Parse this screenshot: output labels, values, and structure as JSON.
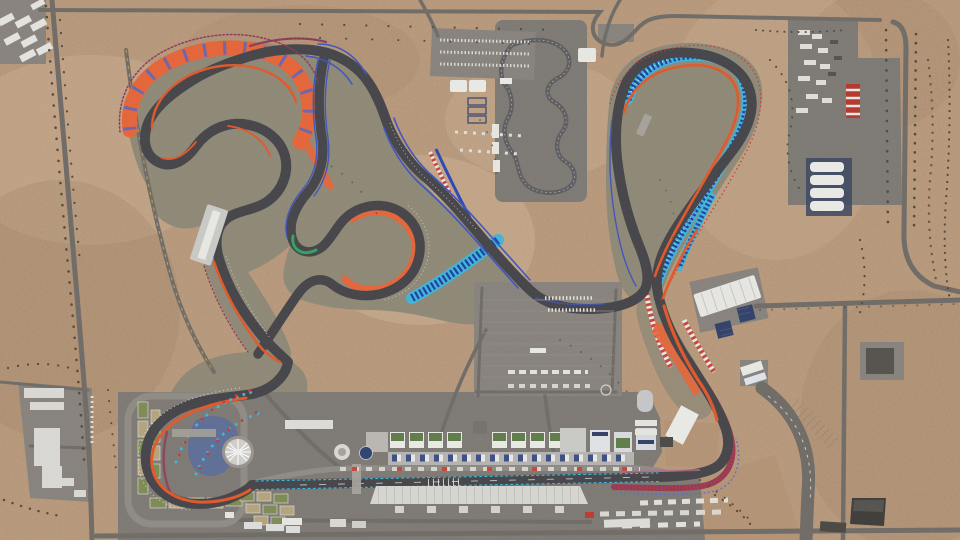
{
  "scene": {
    "title": "Aerial top-down view of a desert grand prix circuit complex",
    "view": "bird's-eye satellite style render",
    "terrain": "sandy desert with scattered scrub vegetation",
    "landmarks": {
      "main_circuit": "dark asphalt grand prix track with orange and blue kerb lines",
      "patterned_runoff": "teal and navy geometric-pattern runoff bands",
      "pit_complex": "pit buildings with green roofs along the start/finish straight",
      "main_grandstand": "long white-roofed grandstand south of the main straight",
      "sw_hairpin_gardens": "landscaped garden beds around the west hairpin",
      "canopy_structure": "white radial canopy sculpture inside the west hairpin",
      "kart_track": "small karting circuit on its own paved pad",
      "ne_paddock": "paved paddock with trucks, containers and warehouses",
      "parking_lot": "central car and coach parking area",
      "perimeter_roads": "gray access roads around the venue"
    }
  },
  "palette": {
    "desert": "#b39376",
    "desertL": "#c9ad90",
    "desertD": "#97795d",
    "zone": "#8e8877",
    "apron": "#7d7974",
    "apron2": "#87827d",
    "road": "#6f6b66",
    "track": "#45454a",
    "orange": "#e0582a",
    "salmon": "#e4653a",
    "red": "#c23b3b",
    "candy": "#c8463c",
    "maroon": "#8e3a58",
    "blue": "#3d55c0",
    "bandblue": "#4a66cc",
    "teal": "#3fb4d8",
    "tealdark": "#1e3fa0",
    "green": "#2fa45c",
    "white": "#e9e9e6",
    "navy": "#32406a",
    "silver": "#c9c9c7",
    "roofgreen": "#5f7c4a",
    "bush": "#524b3a",
    "yellow": "#d8b840"
  }
}
